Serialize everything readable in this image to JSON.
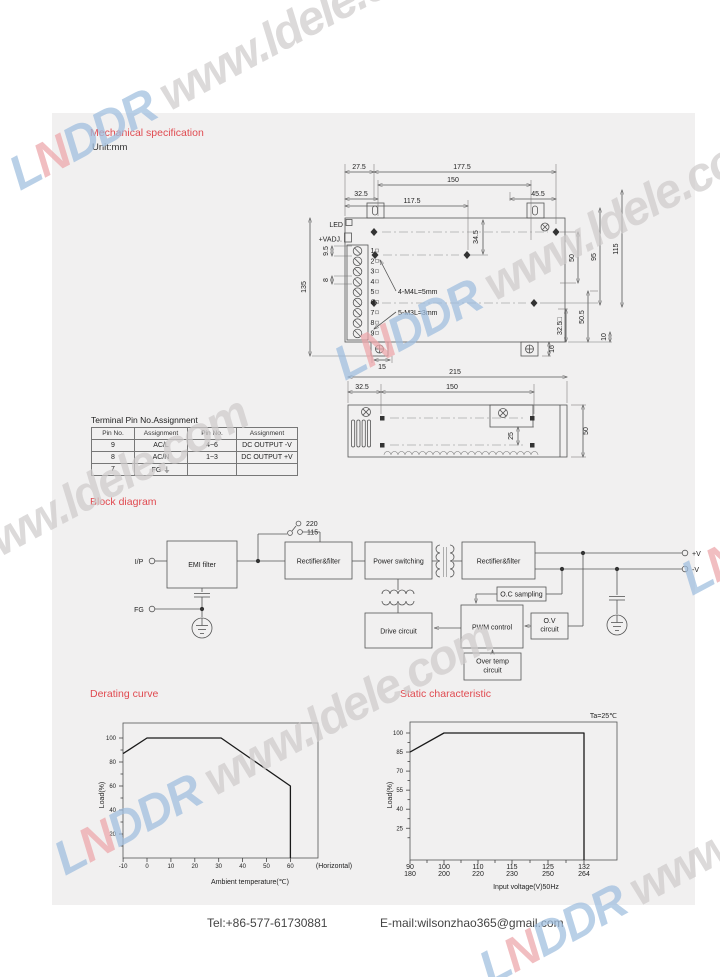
{
  "watermark": {
    "brand": "LNDDR",
    "url": " www.ldele.com",
    "brand_letter_colors": [
      "#9fbedf",
      "#eda6aa",
      "#9fbedf",
      "#9fbedf",
      "#9fbedf"
    ],
    "url_color": "#cfcccc"
  },
  "mechanical": {
    "title": "Mechanical specification",
    "unit": "Unit:mm",
    "labels": {
      "led": "LED",
      "vadj": "+VADJ.",
      "m4": "4-M4L=5mm",
      "m3": "5-M3L=3mm"
    },
    "pins": [
      "1",
      "2",
      "3",
      "4",
      "5",
      "6",
      "7",
      "8",
      "9"
    ],
    "dims": {
      "d27_5": "27.5",
      "d177_5": "177.5",
      "d150": "150",
      "d32_5": "32.5",
      "d117_5": "117.5",
      "d45_5": "45.5",
      "d34_5": "34.5",
      "d9_5": "9.5",
      "d8": "8",
      "d135": "135",
      "d50": "50",
      "d95": "95",
      "d115": "115",
      "d32_5sq": "32.5□",
      "d50_5": "50.5",
      "d10": "10",
      "d16": "16",
      "d15": "15"
    },
    "side_dims": {
      "d215": "215",
      "d32_5": "32.5",
      "d150": "150",
      "d25": "25",
      "d50": "50"
    }
  },
  "terminal_table": {
    "title": "Terminal Pin No.Assignment",
    "headers": [
      "Pin No.",
      "Assignment",
      "Pin No.",
      "Assignment"
    ],
    "rows": [
      [
        "9",
        "AC/L",
        "4~6",
        "DC OUTPUT -V"
      ],
      [
        "8",
        "AC/N",
        "1~3",
        "DC OUTPUT +V"
      ],
      [
        "7",
        "FG ⏚",
        "",
        ""
      ]
    ]
  },
  "block_diagram": {
    "title": "Block diagram",
    "input": "I/P",
    "fg": "FG",
    "switch_220": "220",
    "switch_115": "115",
    "emi": "EMI filter",
    "rect1": "Rectifier&filter",
    "power": "Power switching",
    "rect2": "Rectifier&filter",
    "oc": "O.C sampling",
    "pwm": "PWM control",
    "ov": [
      "O.V",
      "circuit"
    ],
    "overtemp": [
      "Over temp",
      "circuit"
    ],
    "drive": "Drive circuit",
    "out_pos": "+V",
    "out_neg": "-V"
  },
  "derating": {
    "title": "Derating curve"
  },
  "static_char": {
    "title": "Static characteristic"
  },
  "footer": {
    "tel": "Tel:+86-577-61730881",
    "email": "E-mail:wilsonzhao365@gmail.com"
  },
  "chart_data": [
    {
      "type": "line",
      "title": "Derating curve",
      "xlabel": "Ambient temperature(℃)",
      "ylabel": "Load(%)",
      "x_extra_label": "(Horizontal)",
      "xticks": [
        -10,
        0,
        10,
        20,
        30,
        40,
        50,
        60
      ],
      "yticks": [
        20,
        40,
        60,
        80,
        100
      ],
      "y_minor": [
        10,
        30,
        50,
        70,
        90
      ],
      "xlim": [
        -10,
        70
      ],
      "ylim": [
        0,
        112
      ],
      "grid": false,
      "points": [
        [
          -10,
          87
        ],
        [
          0,
          100
        ],
        [
          31,
          100
        ],
        [
          60,
          60
        ],
        [
          60,
          0
        ]
      ]
    },
    {
      "type": "line",
      "title": "Static characteristic",
      "annotation": "Ta=25℃",
      "xlabel": "Input voltage(V)50Hz",
      "ylabel": "Load(%)",
      "xticks_dual": [
        [
          "90",
          "180"
        ],
        [
          "100",
          "200"
        ],
        [
          "110",
          "220"
        ],
        [
          "115",
          "230"
        ],
        [
          "125",
          "250"
        ],
        [
          "132",
          "264"
        ]
      ],
      "yticks": [
        25,
        40,
        55,
        70,
        85,
        100
      ],
      "ylim": [
        0,
        112
      ],
      "grid": false,
      "points": [
        [
          90,
          85
        ],
        [
          100,
          100
        ],
        [
          132,
          100
        ],
        [
          132,
          0
        ]
      ]
    }
  ]
}
